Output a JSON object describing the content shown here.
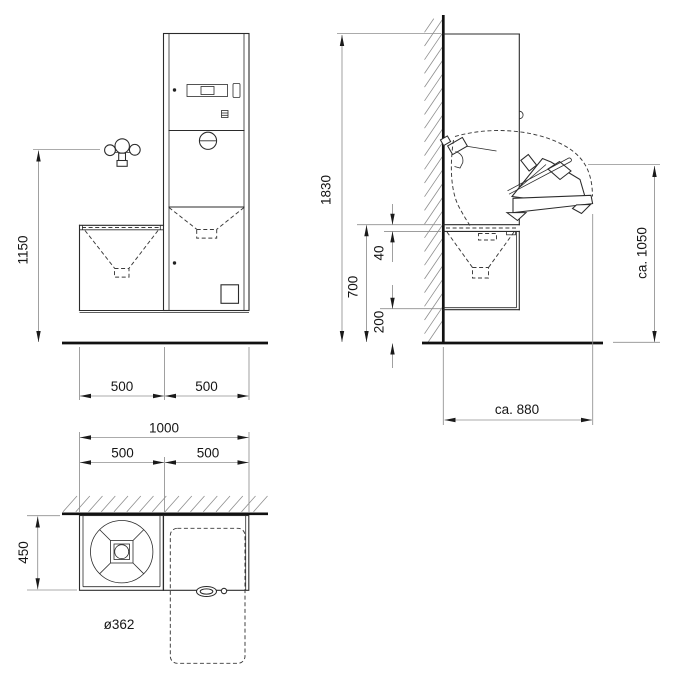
{
  "drawing": {
    "front_view": {
      "faucet_height": "1150",
      "width_left": "500",
      "width_right": "500"
    },
    "side_view": {
      "total_height": "1830",
      "rim_height": "700",
      "rim_thickness": "40",
      "bottom_clearance": "200",
      "open_height": "ca. 1050",
      "open_depth": "ca. 880"
    },
    "plan_view": {
      "total_width": "1000",
      "width_left": "500",
      "width_right": "500",
      "depth": "450",
      "bowl_diameter": "ø362"
    }
  }
}
